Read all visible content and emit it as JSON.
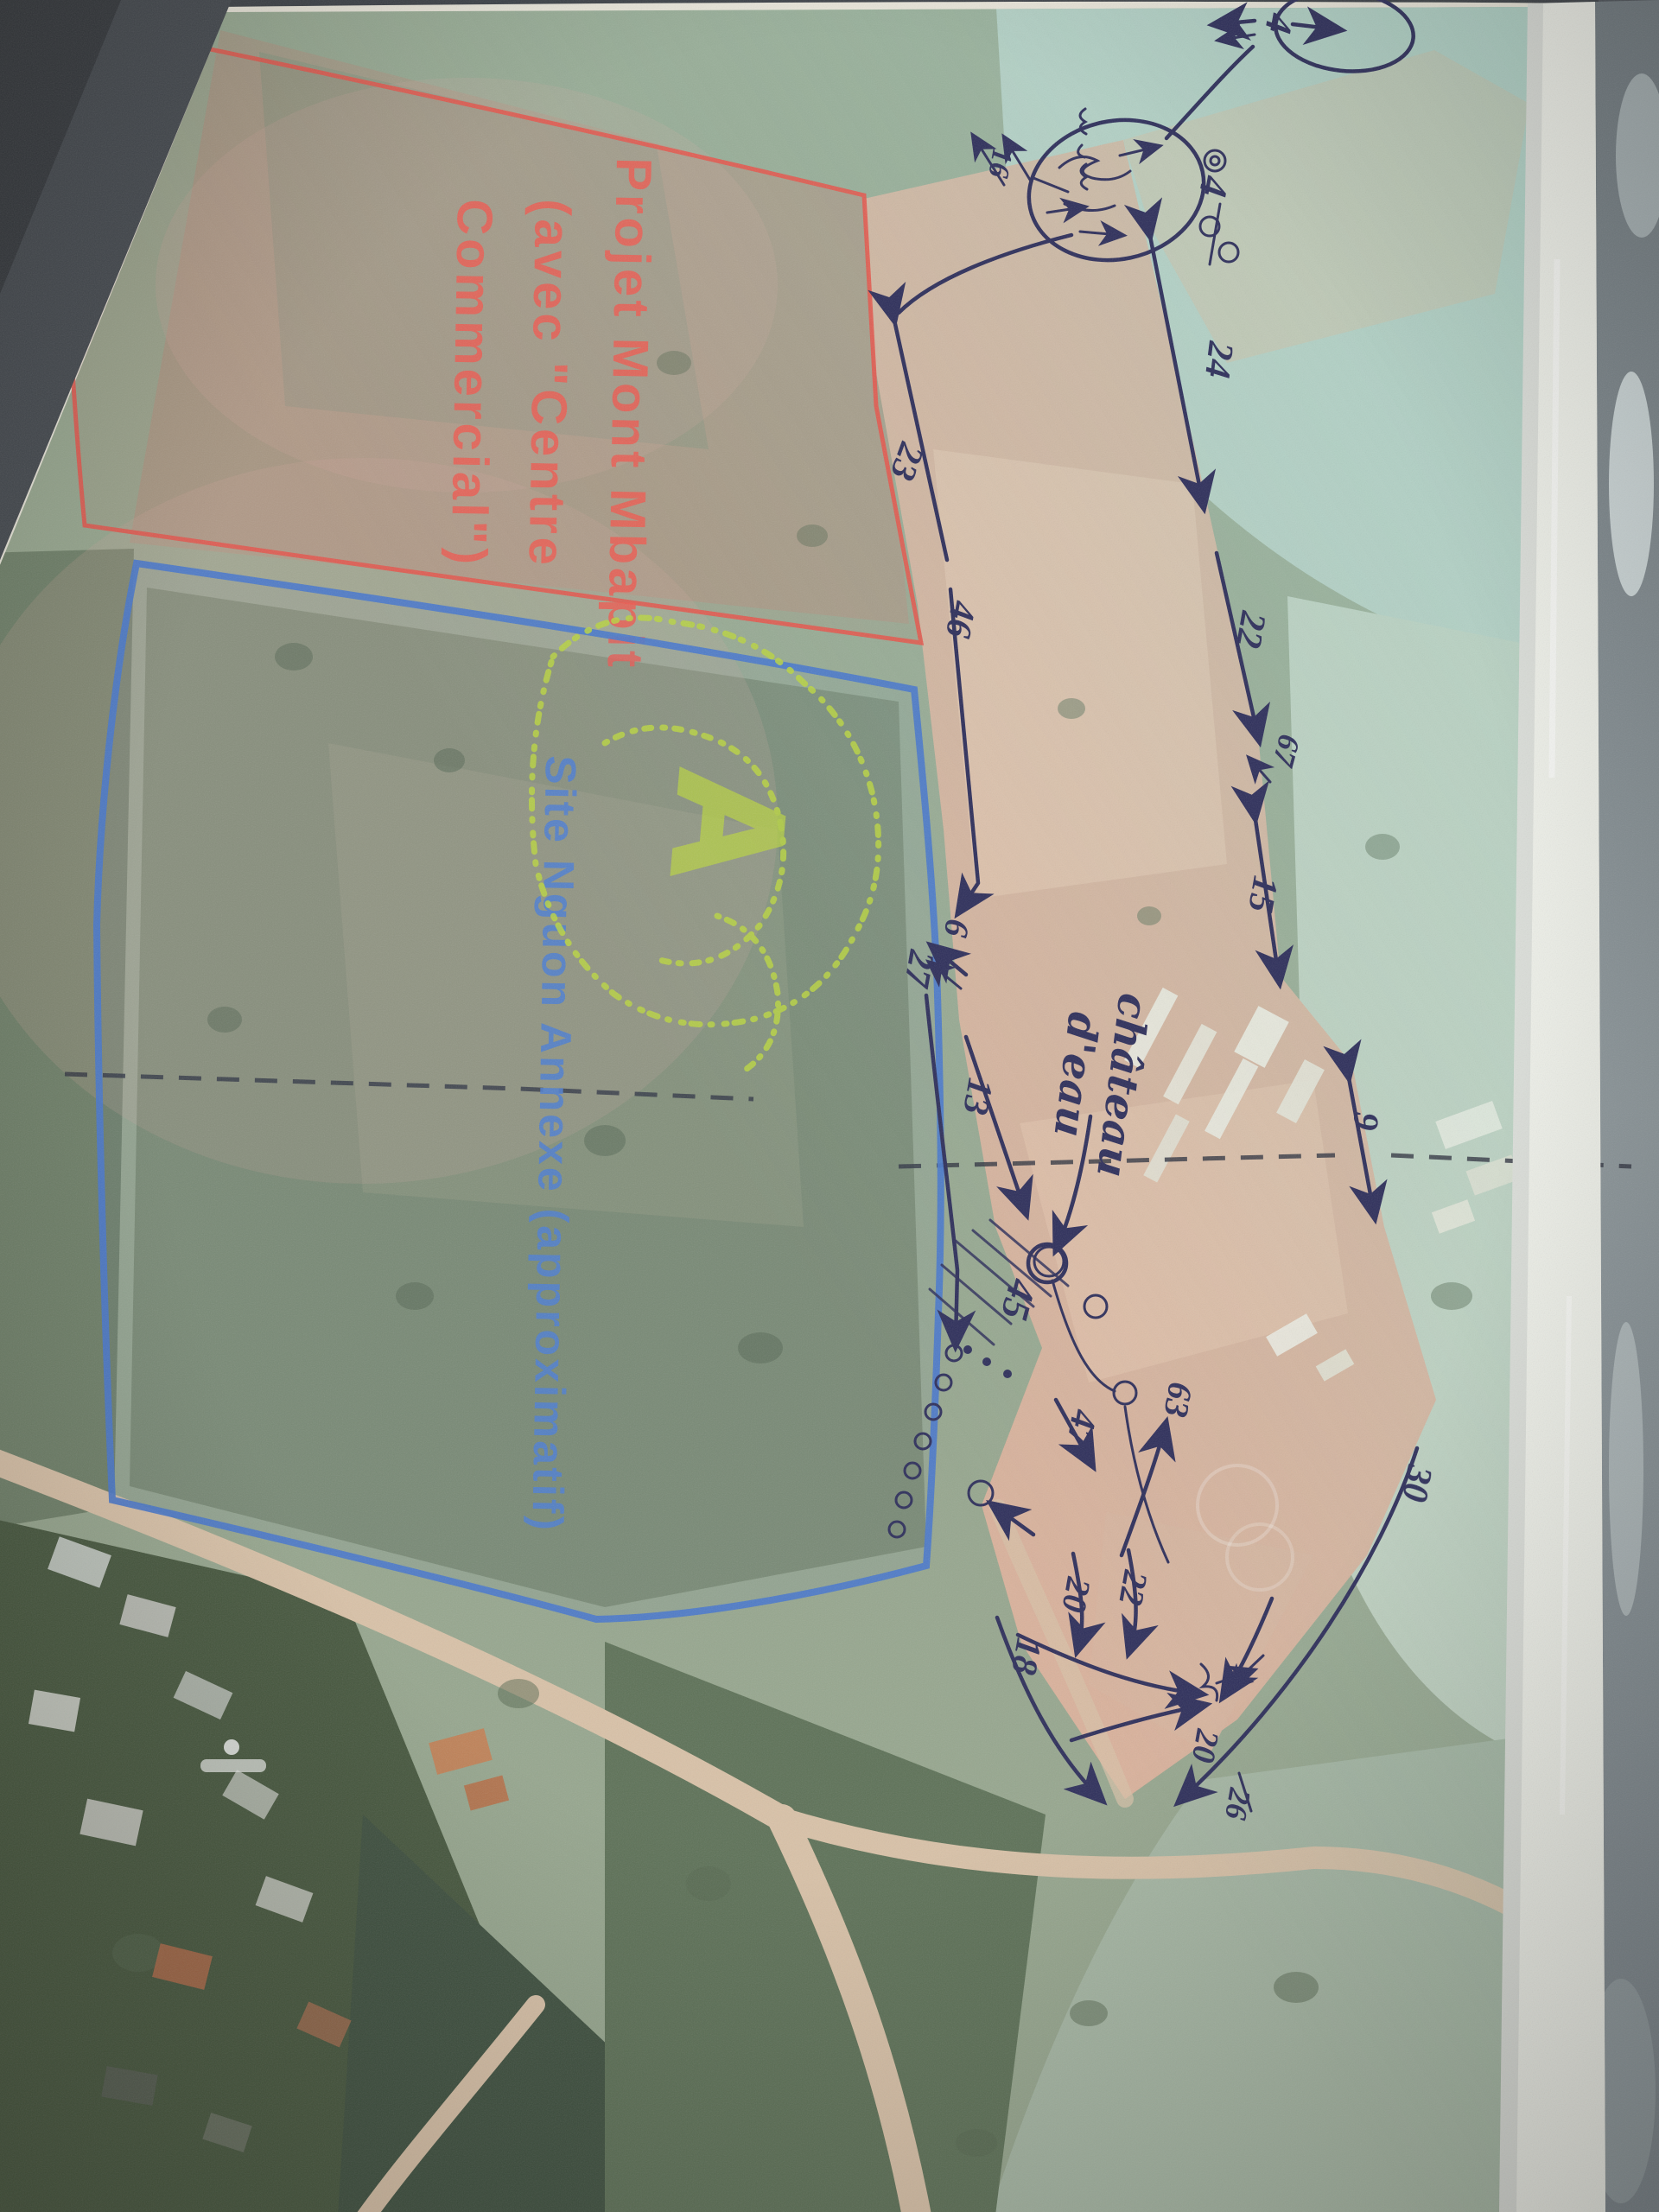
{
  "photo": {
    "surface_color": "#4e545b",
    "paper_color": "#efefe8"
  },
  "map": {
    "printed_labels": {
      "project": {
        "color": "#ee5a50",
        "line1": "Projet Mont Mbapit",
        "line2": "(avec \"Centre",
        "line3": "Commercial\")"
      },
      "site": {
        "color": "#4f7fd0",
        "text": "Site Nguon Annexe (approximatif)"
      },
      "zone_a": {
        "color": "#b9d442",
        "text": "A"
      }
    },
    "handwritten": {
      "ink_color": "#2e2f5b",
      "water_tower": {
        "line1": "château",
        "line2": "d'eau"
      },
      "measurements": [
        {
          "value": "4"
        },
        {
          "value": "16"
        },
        {
          "value": "4"
        },
        {
          "value": "24"
        },
        {
          "value": "22"
        },
        {
          "value": "67"
        },
        {
          "value": "15"
        },
        {
          "value": "9"
        },
        {
          "value": "30"
        },
        {
          "value": "23"
        },
        {
          "value": "46"
        },
        {
          "value": "6"
        },
        {
          "value": "27"
        },
        {
          "value": "13"
        },
        {
          "value": "45"
        },
        {
          "value": "47"
        },
        {
          "value": "63"
        },
        {
          "value": "22"
        },
        {
          "value": "20"
        },
        {
          "value": "18"
        },
        {
          "value": "20"
        },
        {
          "value": "26"
        }
      ]
    }
  }
}
